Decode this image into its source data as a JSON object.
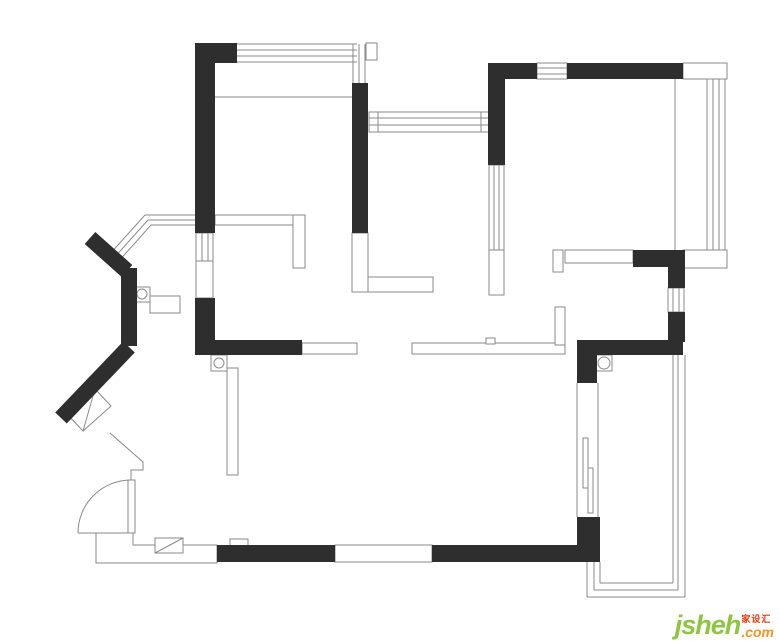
{
  "canvas": {
    "width": 780,
    "height": 641,
    "background": "#ffffff"
  },
  "palette": {
    "wall_fill": "#2e2e2e",
    "thin_line": "#8a8a8a",
    "white": "#ffffff",
    "brand_green": "#8dc63f",
    "brand_orange": "#f7941d",
    "brand_red": "#e8380d"
  },
  "watermark": {
    "brand": "jsheh",
    "cn": "家设汇",
    "tld": ".com"
  },
  "floorplan": {
    "layers": [
      {
        "type": "polygon",
        "items": [
          [
            [
              96,
              533
            ],
            [
              133,
              533
            ],
            [
              133,
              545
            ],
            [
              217,
              545
            ],
            [
              217,
              563
            ],
            [
              96,
              563
            ]
          ],
          [
            [
              67,
              414
            ],
            [
              95,
              389
            ],
            [
              111,
              406
            ],
            [
              83,
              431
            ]
          ]
        ]
      },
      {
        "type": "rect",
        "items": [
          [
            196,
            233,
            17,
            28
          ],
          [
            196,
            261,
            17,
            37
          ],
          [
            215,
            215,
            80,
            10
          ],
          [
            293,
            215,
            12,
            53
          ],
          [
            352,
            233,
            16,
            59
          ],
          [
            368,
            277,
            65,
            15
          ],
          [
            369,
            112,
            121,
            20
          ],
          [
            369,
            112,
            9,
            20
          ],
          [
            481,
            112,
            9,
            20
          ],
          [
            489,
            165,
            15,
            85
          ],
          [
            489,
            250,
            15,
            45
          ],
          [
            537,
            63,
            30,
            16
          ],
          [
            683,
            63,
            44,
            16
          ],
          [
            683,
            250,
            44,
            18
          ],
          [
            668,
            288,
            16,
            24
          ],
          [
            565,
            250,
            68,
            13
          ],
          [
            553,
            250,
            10,
            22
          ],
          [
            302,
            343,
            55,
            11
          ],
          [
            412,
            343,
            153,
            11
          ],
          [
            555,
            307,
            10,
            38
          ],
          [
            486,
            338,
            9,
            6
          ],
          [
            227,
            368,
            11,
            107
          ],
          [
            335,
            545,
            97,
            17
          ],
          [
            155,
            538,
            28,
            15
          ],
          [
            230,
            539,
            18,
            7
          ],
          [
            128,
            480,
            7,
            53
          ],
          [
            135,
            287,
            15,
            15
          ],
          [
            150,
            296,
            30,
            17
          ],
          [
            211,
            355,
            16,
            16
          ],
          [
            596,
            355,
            16,
            16
          ],
          [
            583,
            438,
            5,
            50
          ],
          [
            588,
            468,
            5,
            45
          ],
          [
            366,
            43,
            11,
            17
          ]
        ]
      },
      {
        "type": "line",
        "items": [
          [
            237,
            44,
            357,
            44
          ],
          [
            237,
            50,
            357,
            50
          ],
          [
            237,
            56,
            357,
            56
          ],
          [
            237,
            62,
            357,
            62
          ],
          [
            353,
            44,
            353,
            83
          ],
          [
            359,
            44,
            359,
            83
          ],
          [
            365,
            44,
            365,
            83
          ],
          [
            215,
            97,
            352,
            97
          ],
          [
            202,
            233,
            202,
            261
          ],
          [
            208,
            233,
            208,
            261
          ],
          [
            369,
            118,
            490,
            118
          ],
          [
            369,
            125,
            490,
            125
          ],
          [
            494,
            165,
            494,
            250
          ],
          [
            499,
            165,
            499,
            250
          ],
          [
            537,
            68,
            567,
            68
          ],
          [
            537,
            74,
            567,
            74
          ],
          [
            675,
            79,
            675,
            250
          ],
          [
            707,
            79,
            707,
            250
          ],
          [
            713,
            79,
            713,
            250
          ],
          [
            719,
            79,
            719,
            250
          ],
          [
            725,
            79,
            725,
            250
          ],
          [
            673,
            288,
            673,
            312
          ],
          [
            679,
            288,
            679,
            312
          ],
          [
            685,
            355,
            685,
            597
          ],
          [
            678,
            355,
            678,
            590
          ],
          [
            587,
            597,
            685,
            597
          ],
          [
            594,
            590,
            678,
            590
          ],
          [
            587,
            562,
            587,
            597
          ],
          [
            594,
            562,
            594,
            590
          ],
          [
            673,
            355,
            673,
            583
          ],
          [
            600,
            583,
            673,
            583
          ],
          [
            600,
            562,
            600,
            583
          ],
          [
            577,
            383,
            577,
            517
          ],
          [
            598,
            383,
            598,
            517
          ],
          [
            78,
            533,
            96,
            533
          ],
          [
            155,
            553,
            183,
            538
          ],
          [
            95,
            389,
            83,
            431
          ]
        ]
      },
      {
        "type": "polyline",
        "items": [
          [
            [
              109,
              255
            ],
            [
              145,
              215
            ],
            [
              215,
              215
            ]
          ],
          [
            [
              113,
              259
            ],
            [
              148,
              220
            ],
            [
              215,
              220
            ]
          ],
          [
            [
              117,
              263
            ],
            [
              151,
              225
            ],
            [
              215,
              225
            ]
          ],
          [
            [
              110,
              433
            ],
            [
              143,
              462
            ],
            [
              143,
              470
            ],
            [
              131,
              470
            ],
            [
              131,
              480
            ]
          ]
        ]
      },
      {
        "type": "path",
        "items": [
          "M 131 480 A 53 53 0 0 0 78 533"
        ]
      },
      {
        "type": "circle",
        "items": [
          [
            142,
            294,
            5
          ],
          [
            219,
            363,
            5
          ],
          [
            604,
            363,
            6
          ]
        ]
      },
      {
        "type": "wallrect",
        "items": [
          [
            195,
            43,
            42,
            20
          ],
          [
            195,
            43,
            20,
            190
          ],
          [
            195,
            298,
            20,
            57
          ],
          [
            195,
            340,
            107,
            15
          ],
          [
            352,
            83,
            16,
            150
          ],
          [
            488,
            63,
            17,
            102
          ],
          [
            488,
            63,
            49,
            16
          ],
          [
            567,
            63,
            116,
            16
          ],
          [
            633,
            250,
            50,
            17
          ],
          [
            668,
            250,
            17,
            38
          ],
          [
            668,
            312,
            17,
            30
          ],
          [
            577,
            340,
            106,
            15
          ],
          [
            577,
            340,
            20,
            43
          ],
          [
            577,
            517,
            23,
            45
          ],
          [
            432,
            545,
            168,
            17
          ],
          [
            217,
            545,
            118,
            17
          ],
          [
            121,
            268,
            16,
            78
          ]
        ]
      },
      {
        "type": "wallline",
        "width": 16,
        "items": [
          [
            90,
            238,
            127,
            271
          ],
          [
            129,
            347,
            61,
            418
          ]
        ]
      }
    ]
  }
}
